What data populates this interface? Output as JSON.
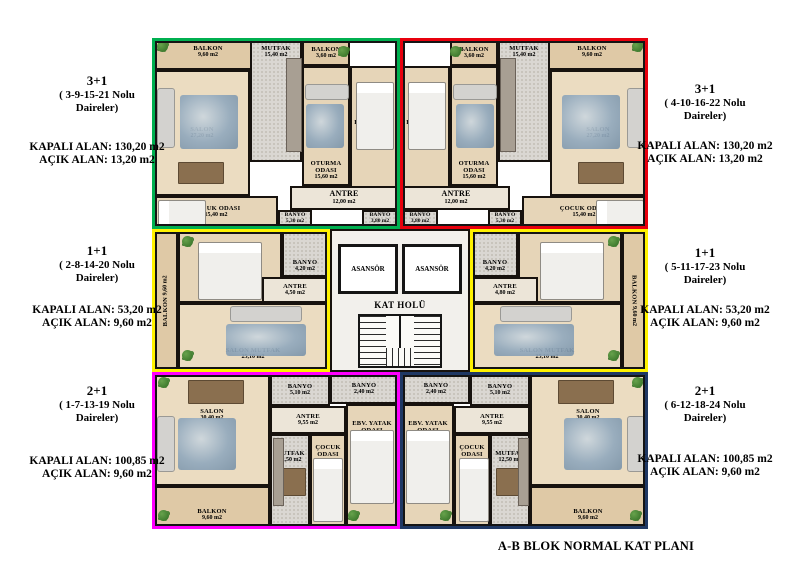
{
  "title": "A-B BLOK NORMAL KAT PLANI",
  "legend": {
    "left": [
      {
        "type": "3+1",
        "units1": "( 3-9-15-21 Nolu",
        "units2": "Daireler)",
        "kapali": "KAPALI ALAN: 130,20 m2",
        "acik": "AÇIK ALAN: 13,20 m2"
      },
      {
        "type": "1+1",
        "units1": "( 2-8-14-20 Nolu",
        "units2": "Daireler)",
        "kapali": "KAPALI ALAN: 53,20 m2",
        "acik": "AÇIK ALAN: 9,60 m2"
      },
      {
        "type": "2+1",
        "units1": "( 1-7-13-19 Nolu",
        "units2": "Daireler)",
        "kapali": "KAPALI ALAN: 100,85 m2",
        "acik": "AÇIK ALAN: 9,60 m2"
      }
    ],
    "right": [
      {
        "type": "3+1",
        "units1": "( 4-10-16-22 Nolu",
        "units2": "Daireler)",
        "kapali": "KAPALI ALAN: 130,20 m2",
        "acik": "AÇIK ALAN: 13,20 m2"
      },
      {
        "type": "1+1",
        "units1": "( 5-11-17-23 Nolu",
        "units2": "Daireler)",
        "kapali": "KAPALI ALAN: 53,20 m2",
        "acik": "AÇIK ALAN: 9,60 m2"
      },
      {
        "type": "2+1",
        "units1": "( 6-12-18-24 Nolu",
        "units2": "Daireler)",
        "kapali": "KAPALI ALAN: 100,85 m2",
        "acik": "AÇIK ALAN: 9,60 m2"
      }
    ]
  },
  "core": {
    "elevator_left": "ASANSÖR",
    "elevator_right": "ASANSÖR",
    "hall": "KAT HOLÜ"
  },
  "colors": {
    "outline_top_left": "#00b050",
    "outline_top_right": "#e8000d",
    "outline_mid_left": "#fff200",
    "outline_mid_right": "#fff200",
    "outline_bottom_left": "#ff00ff",
    "outline_bottom_right": "#1f3864"
  },
  "apartments": {
    "top_left": {
      "rooms": {
        "balkon1": {
          "name": "BALKON",
          "area": "9,60 m2"
        },
        "mutfak": {
          "name": "MUTFAK",
          "area": "15,40 m2"
        },
        "balkon2": {
          "name": "BALKON",
          "area": "3,60 m2"
        },
        "salon": {
          "name": "SALON",
          "area": "27,20 m2"
        },
        "oturma": {
          "name": "OTURMA ODASI",
          "area": "15,60 m2"
        },
        "ebv_yatak": {
          "name": "EBV. YATAK ODASI",
          "area": "21,60 m2"
        },
        "antre": {
          "name": "ANTRE",
          "area": "12,00 m2"
        },
        "cocuk": {
          "name": "ÇOCUK ODASI",
          "area": "15,40 m2"
        },
        "banyo1": {
          "name": "BANYO",
          "area": "5,30 m2"
        },
        "banyo2": {
          "name": "BANYO",
          "area": "3,80 m2"
        }
      }
    },
    "top_right": {
      "rooms": {
        "balkon1": {
          "name": "BALKON",
          "area": "9,60 m2"
        },
        "mutfak": {
          "name": "MUTFAK",
          "area": "15,40 m2"
        },
        "balkon2": {
          "name": "BALKON",
          "area": "3,60 m2"
        },
        "salon": {
          "name": "SALON",
          "area": "27,20 m2"
        },
        "oturma": {
          "name": "OTURMA ODASI",
          "area": "15,60 m2"
        },
        "ebv_yatak": {
          "name": "EBV. YATAK ODASI",
          "area": "21,60 m2"
        },
        "antre": {
          "name": "ANTRE",
          "area": "12,00 m2"
        },
        "cocuk": {
          "name": "ÇOCUK ODASI",
          "area": "15,40 m2"
        },
        "banyo1": {
          "name": "BANYO",
          "area": "5,30 m2"
        },
        "banyo2": {
          "name": "BANYO",
          "area": "3,80 m2"
        }
      }
    },
    "mid_left": {
      "rooms": {
        "balkon": {
          "name": "BALKON",
          "area": "9,60 m2"
        },
        "yatak": {
          "name": "YATAK ODASI",
          "area": "12,90 m2"
        },
        "banyo": {
          "name": "BANYO",
          "area": "4,20 m2"
        },
        "antre": {
          "name": "ANTRE",
          "area": "4,50 m2"
        },
        "salon_mutfak": {
          "name": "SALON MUTFAK",
          "area": "25,10 m2"
        }
      }
    },
    "mid_right": {
      "rooms": {
        "balkon": {
          "name": "BALKON",
          "area": "9,60 m2"
        },
        "yatak": {
          "name": "YATAK ODASI",
          "area": "12,90 m2"
        },
        "banyo": {
          "name": "BANYO",
          "area": "4,20 m2"
        },
        "antre": {
          "name": "ANTRE",
          "area": "4,80 m2"
        },
        "salon_mutfak": {
          "name": "SALON MUTFAK",
          "area": "25,10 m2"
        }
      }
    },
    "bottom_left": {
      "rooms": {
        "salon": {
          "name": "SALON",
          "area": "30,40 m2"
        },
        "balkon": {
          "name": "BALKON",
          "area": "9,60 m2"
        },
        "banyo1": {
          "name": "BANYO",
          "area": "5,10 m2"
        },
        "antre": {
          "name": "ANTRE",
          "area": "9,55 m2"
        },
        "mutfak": {
          "name": "MUTFAK",
          "area": "12,50 m2"
        },
        "cocuk": {
          "name": "ÇOCUK ODASI",
          "area": "12,60 m2"
        },
        "banyo2": {
          "name": "BANYO",
          "area": "2,40 m2"
        },
        "ebv_yatak": {
          "name": "EBV. YATAK ODASI",
          "area": "17,65 m2"
        }
      }
    },
    "bottom_right": {
      "rooms": {
        "salon": {
          "name": "SALON",
          "area": "30,40 m2"
        },
        "balkon": {
          "name": "BALKON",
          "area": "9,60 m2"
        },
        "banyo1": {
          "name": "BANYO",
          "area": "5,10 m2"
        },
        "antre": {
          "name": "ANTRE",
          "area": "9,55 m2"
        },
        "mutfak": {
          "name": "MUTFAK",
          "area": "12,50 m2"
        },
        "cocuk": {
          "name": "ÇOCUK ODASI",
          "area": "12,60 m2"
        },
        "banyo2": {
          "name": "BANYO",
          "area": "2,40 m2"
        },
        "ebv_yatak": {
          "name": "EBV. YATAK ODASI",
          "area": "17,65 m2"
        }
      }
    }
  }
}
